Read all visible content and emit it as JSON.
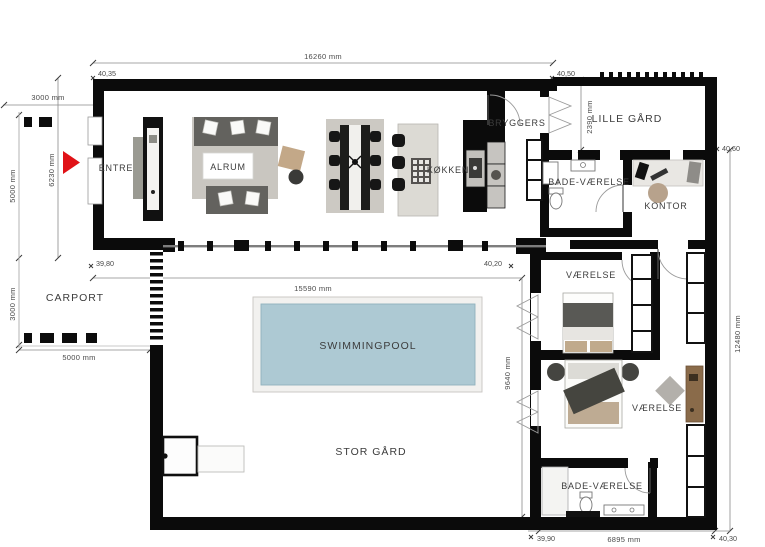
{
  "plan": {
    "rooms": {
      "entre": "ENTRE",
      "alrum": "ALRUM",
      "kokken": "KØKKEN",
      "bryggers": "BRYGGERS",
      "lille_gaard": "LILLE GÅRD",
      "bad_top": "BADE-VÆRELSE",
      "kontor": "KONTOR",
      "carport": "CARPORT",
      "vaerelse_top": "VÆRELSE",
      "vaerelse_bottom": "VÆRELSE",
      "bad_bottom": "BADE-VÆRELSE",
      "pool": "SWIMMINGPOOL",
      "stor_gaard": "STOR GÅRD"
    },
    "dims": {
      "top_width": "16260 mm",
      "carport_top": "3000 mm",
      "left_outer": "5000 mm",
      "left_inner": "6230 mm",
      "carport_left": "3000 mm",
      "carport_bottom": "5000 mm",
      "court_width": "15590 mm",
      "court_height": "9640 mm",
      "lille_gaard_depth": "2390 mm",
      "right_height": "12480 mm",
      "bottom_width": "6895 mm"
    },
    "levels": {
      "top_left": "40,35",
      "top_right": "40,50",
      "mid_left": "39,80",
      "mid_right": "40,20",
      "right_upper": "40,60",
      "bottom_left": "39,90",
      "bottom_right": "40,30"
    },
    "colors": {
      "wall": "#0b0b0b",
      "pool_water": "#adc9d3",
      "pool_edge": "#8fb2bd",
      "accent_red": "#e01217",
      "rug": "#c9c6c0",
      "sofa": "#63625e",
      "wood": "#8a6b4a"
    }
  }
}
